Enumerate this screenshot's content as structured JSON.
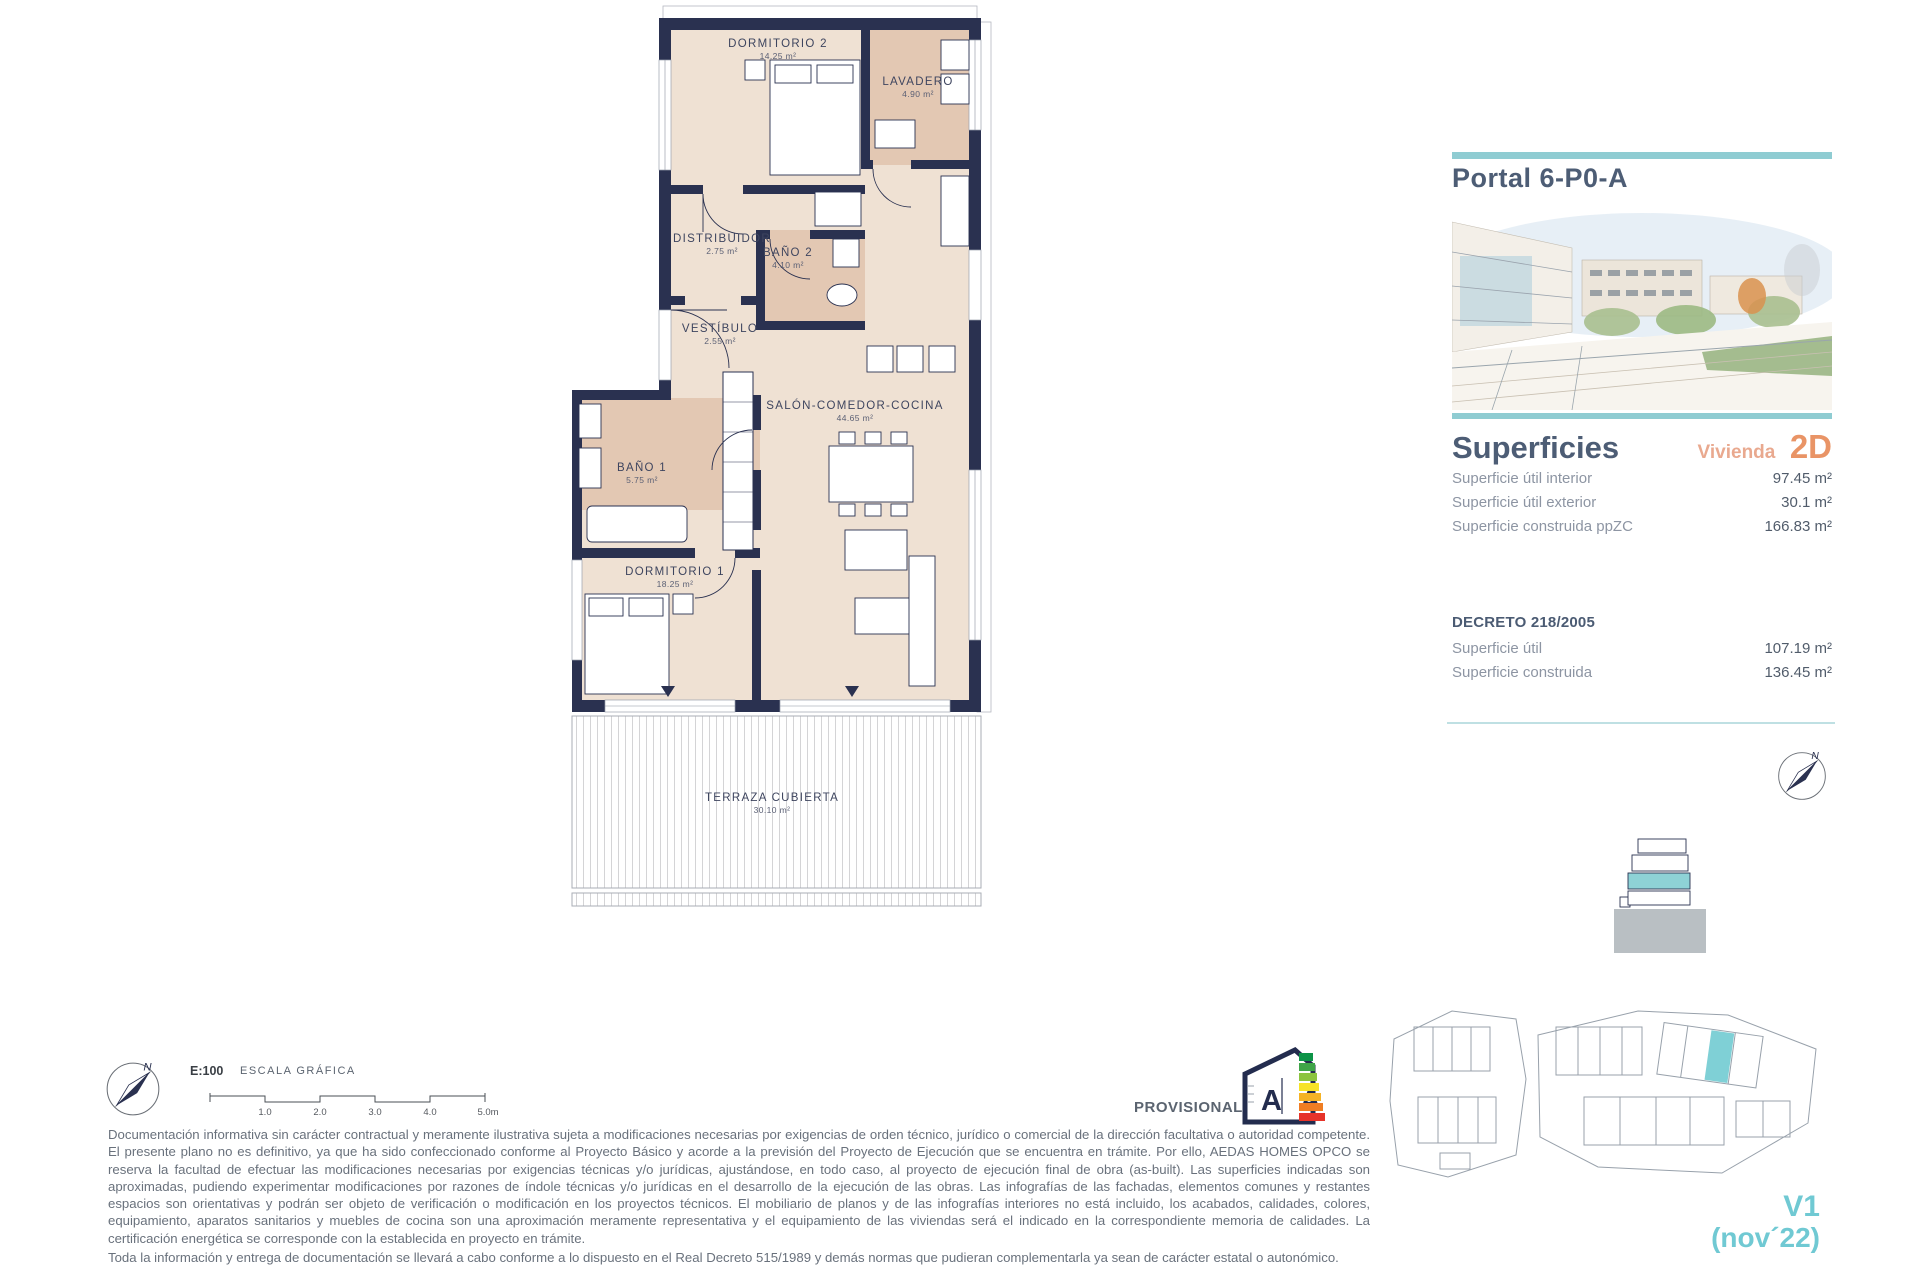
{
  "colors": {
    "wall_navy": "#2a3150",
    "floor_beige": "#efe1d3",
    "wet_room_tan": "#e3c8b3",
    "accent_teal": "#8fccd2",
    "highlight_teal": "#7fd0d6",
    "accent_salmon": "#e99466",
    "heading_slate": "#4d5d75"
  },
  "plan": {
    "rooms": [
      {
        "name": "DORMITORIO 2",
        "area": "14.25 m²"
      },
      {
        "name": "LAVADERO",
        "area": "4.90 m²"
      },
      {
        "name": "DISTRIBUIDOR",
        "area": "2.75 m²"
      },
      {
        "name": "BAÑO 2",
        "area": "4.10 m²"
      },
      {
        "name": "VESTÍBULO",
        "area": "2.55 m²"
      },
      {
        "name": "SALÓN-COMEDOR-COCINA",
        "area": "44.65 m²"
      },
      {
        "name": "BAÑO 1",
        "area": "5.75 m²"
      },
      {
        "name": "DORMITORIO 1",
        "area": "18.25 m²"
      },
      {
        "name": "TERRAZA CUBIERTA",
        "area": "30.10 m²"
      }
    ],
    "compass_label": "N"
  },
  "sidebar": {
    "portal_title": "Portal 6-P0-A",
    "superficies": {
      "heading": "Superficies",
      "vivienda_label": "Vivienda",
      "vivienda_code": "2D",
      "rows": [
        {
          "label": "Superficie útil interior",
          "value": "97.45 m²"
        },
        {
          "label": "Superficie útil exterior",
          "value": "30.1 m²"
        },
        {
          "label": "Superficie construida ppZC",
          "value": "166.83 m²"
        }
      ]
    },
    "decreto": {
      "heading": "DECRETO 218/2005",
      "rows": [
        {
          "label": "Superficie útil",
          "value": "107.19 m²"
        },
        {
          "label": "Superficie construida",
          "value": "136.45 m²"
        }
      ]
    },
    "compass_label": "N",
    "version_line1": "V1",
    "version_line2": "(nov´22)"
  },
  "footer": {
    "scale_label": "E:100",
    "scale_caption": "ESCALA GRÁFICA",
    "scale_ticks": [
      "1.0",
      "2.0",
      "3.0",
      "4.0",
      "5.0m"
    ],
    "provisional_label": "PROVISIONAL",
    "energy_letters": "A A",
    "disclaimer1": "Documentación informativa sin carácter contractual y meramente ilustrativa sujeta a modificaciones necesarias por exigencias de orden técnico, jurídico o comercial de la dirección facultativa o autoridad competente. El presente plano no es definitivo, ya que ha sido  confeccionado conforme al Proyecto Básico y acorde a la previsión del Proyecto de Ejecución que se encuentra en trámite. Por ello, AEDAS HOMES OPCO se reserva la facultad de efectuar las modificaciones necesarias por exigencias técnicas y/o jurídicas, ajustándose, en todo caso, al proyecto de ejecución final de obra (as-built). Las superficies indicadas son aproximadas, pudiendo experimentar modificaciones por razones de índole técnicas y/o jurídicas en el desarrollo de la ejecución de las obras. Las infografías de las fachadas, elementos comunes y restantes espacios son orientativas y podrán ser objeto de verificación o modificación en los proyectos técnicos. El mobiliario de planos y de las infografías interiores no está incluido, los acabados, calidades, colores, equipamiento, aparatos sanitarios y muebles de cocina son una aproximación meramente representativa y el equipamiento de las viviendas será el indicado en la correspondiente memoria de calidades. La certificación energética se corresponde con la establecida en proyecto en trámite.",
    "disclaimer2": "Toda la información y entrega de documentación se llevará a cabo conforme a lo dispuesto en el Real Decreto 515/1989 y demás normas que pudieran complementarla ya sean de carácter estatal o autonómico."
  }
}
